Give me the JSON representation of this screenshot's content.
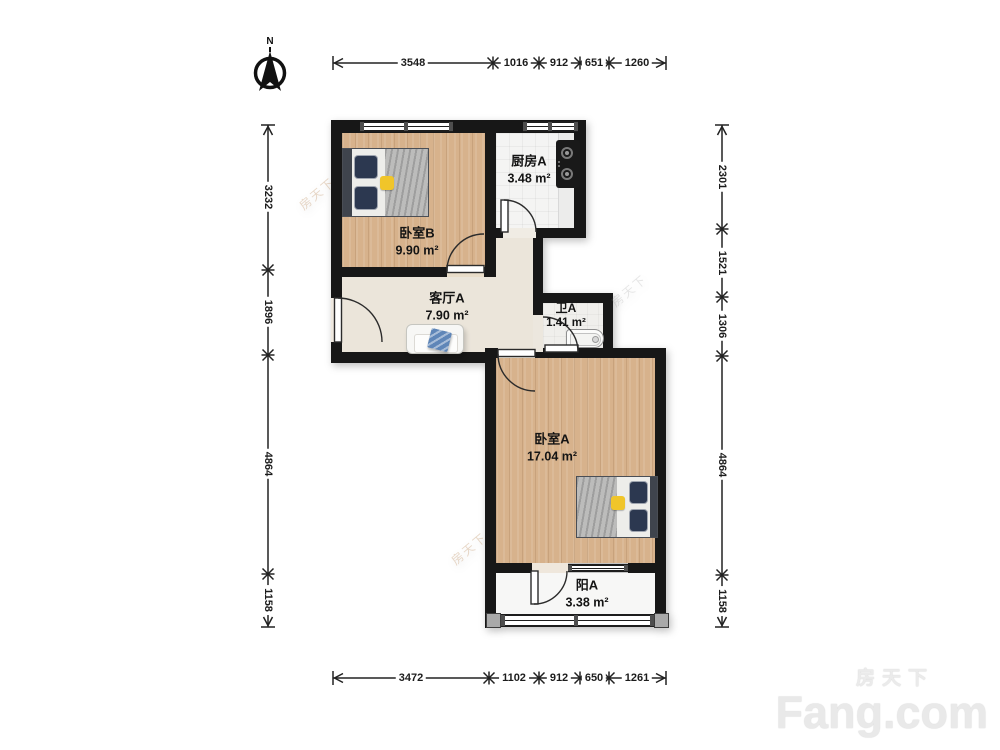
{
  "compass": {
    "label": "N"
  },
  "rooms": {
    "bedroom_b": {
      "name": "卧室B",
      "area": "9.90 m²"
    },
    "kitchen_a": {
      "name": "厨房A",
      "area": "3.48 m²"
    },
    "living_a": {
      "name": "客厅A",
      "area": "7.90 m²"
    },
    "bath_a": {
      "name": "卫A",
      "area": "1.41 m²"
    },
    "bedroom_a": {
      "name": "卧室A",
      "area": "17.04 m²"
    },
    "balcony_a": {
      "name": "阳A",
      "area": "3.38 m²"
    }
  },
  "dims": {
    "top": [
      "3548",
      "1016",
      "912",
      "651",
      "1260"
    ],
    "bottom": [
      "3472",
      "1102",
      "912",
      "650",
      "1261"
    ],
    "left": [
      "3232",
      "1896",
      "4864",
      "1158"
    ],
    "right": [
      "2301",
      "1521",
      "1306",
      "4864",
      "1158"
    ]
  },
  "brand": {
    "cn": "房天下",
    "en": "Fang.com"
  },
  "colors": {
    "wall": "#171717",
    "wood_floor": "#d7b28c",
    "cream_floor": "#ebe5da",
    "tile_floor": "#f4f4f3",
    "accent_yellow": "#f0c52a",
    "pillow_navy": "#2c3850",
    "throw_blue": "#5f86b8"
  }
}
